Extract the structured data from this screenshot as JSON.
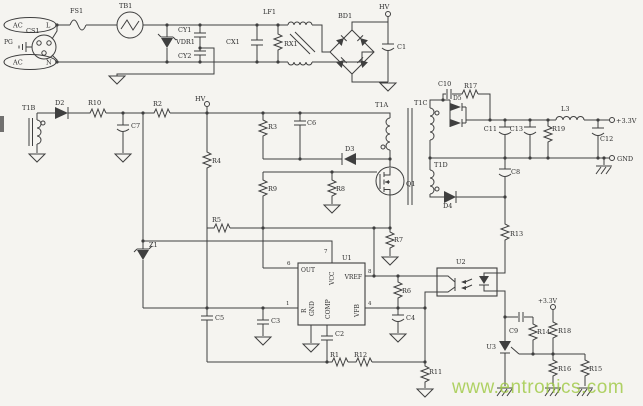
{
  "colors": {
    "wire": "#3f3f3f",
    "watermark_green": "#9cc83e",
    "paper": "#f5f4f0"
  },
  "watermark": "www.entronics.com",
  "input": {
    "ac_l": "AC",
    "l": "L",
    "ac_n": "AC",
    "n": "N",
    "cs1": "CS1",
    "pg": "PG",
    "fs1": "FS1",
    "tb1": "TB1",
    "vdr1": "VDR1",
    "cy1": "CY1",
    "cy2": "CY2",
    "cx1": "CX1",
    "rx1": "RX1",
    "lf1": "LF1",
    "bd1": "BD1",
    "c1": "C1",
    "hv": "HV"
  },
  "aux": {
    "t1b": "T1B",
    "d2": "D2",
    "r10": "R10",
    "c7": "C7",
    "r2": "R2",
    "hv": "HV",
    "r4": "R4",
    "r5": "R5",
    "z1": "Z1"
  },
  "primary": {
    "r3": "R3",
    "c6": "C6",
    "d3": "D3",
    "t1a": "T1A",
    "q1": "Q1",
    "r9": "R9",
    "r8": "R8",
    "r7": "R7"
  },
  "controller": {
    "u1": "U1",
    "pin_out": "OUT",
    "pin_vcc": "VCC",
    "pin_vref": "VREF",
    "pin_vfb": "VFB",
    "pin_r": "R",
    "pin_gnd": "GND",
    "pin_comp": "COMP",
    "n1": "1",
    "n4": "4",
    "n6": "6",
    "n7": "7",
    "n8": "8",
    "r6": "R6",
    "c4": "C4",
    "c2": "C2",
    "r1": "R1",
    "r12": "R12",
    "r11": "R11",
    "c5": "C5",
    "c3": "C3"
  },
  "secondary": {
    "t1c": "T1C",
    "t1d": "T1D",
    "d5": "D5",
    "d4": "D4",
    "c10": "C10",
    "r17": "R17",
    "c8": "C8",
    "c11": "C11",
    "c13": "C13",
    "r19": "R19",
    "l3": "L3",
    "c12": "C12",
    "vout": "+3.3V",
    "gnd": "GND"
  },
  "feedback": {
    "r13": "R13",
    "u2": "U2",
    "u3": "U3",
    "c9": "C9",
    "r14": "R14",
    "r18": "R18",
    "v33": "+3.3V",
    "r16": "R16",
    "r15": "R15"
  }
}
